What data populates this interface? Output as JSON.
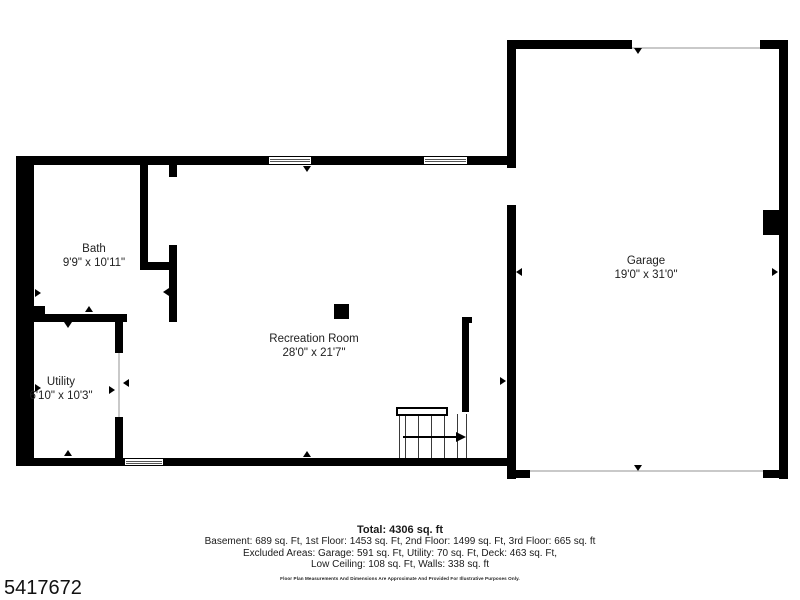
{
  "page": {
    "background": "#ffffff",
    "wall_color": "#000000",
    "listing_id": "5417672"
  },
  "rooms": {
    "bath": {
      "name": "Bath",
      "dims": "9'9\" x 10'11\""
    },
    "utility": {
      "name": "Utility",
      "dims": "6'10\" x 10'3\""
    },
    "recreation": {
      "name": "Recreation Room",
      "dims": "28'0\" x 21'7\""
    },
    "garage": {
      "name": "Garage",
      "dims": "19'0\" x 31'0\""
    }
  },
  "summary": {
    "total": "Total: 4306 sq. ft",
    "floors": "Basement: 689 sq. Ft, 1st Floor: 1453 sq. Ft, 2nd Floor: 1499 sq. Ft, 3rd Floor: 665 sq. ft",
    "excluded": "Excluded Areas: Garage: 591 sq. Ft, Utility: 70 sq. Ft, Deck: 463 sq. Ft,",
    "low_ceiling": "Low Ceiling: 108 sq. Ft, Walls: 338 sq. ft",
    "disclaimer": "Floor Plan Measurements And Dimensions Are Approximate And Provided For Illustrative Purposes Only."
  }
}
